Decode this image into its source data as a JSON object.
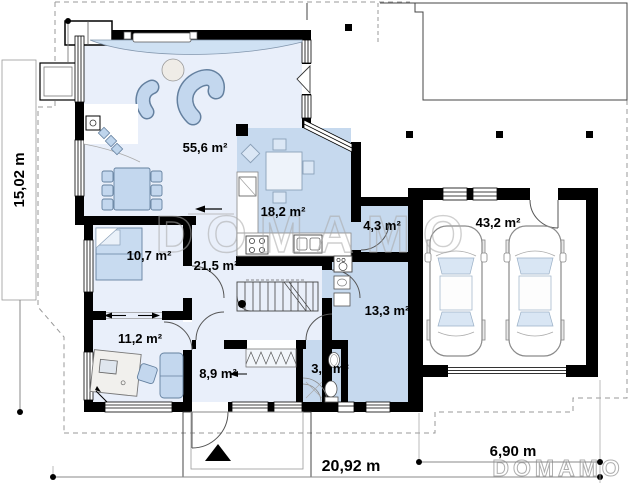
{
  "plan": {
    "watermark_center": "DOMAMO",
    "watermark_corner": "DOMAMO",
    "dimensions": {
      "height_left": "15,02 m",
      "width_bottom": "20,92 m",
      "garage_width": "6,90 m"
    },
    "rooms": [
      {
        "name": "living-room",
        "area": "55,6 m²"
      },
      {
        "name": "kitchen-dining",
        "area": "18,2 m²"
      },
      {
        "name": "pantry",
        "area": "4,3 m²"
      },
      {
        "name": "garage",
        "area": "43,2 m²"
      },
      {
        "name": "bedroom",
        "area": "10,7 m²"
      },
      {
        "name": "hall",
        "area": "21,5 m²"
      },
      {
        "name": "office",
        "area": "11,2 m²"
      },
      {
        "name": "corridor",
        "area": "8,9 m²"
      },
      {
        "name": "wc",
        "area": "3,8 m²"
      },
      {
        "name": "utility",
        "area": "13,3 m²"
      }
    ]
  },
  "colors": {
    "wall": "#000000",
    "room_light": "#e9effa",
    "room_medium": "#c6d9ee",
    "furniture": "#c3d7ee",
    "furniture_stroke": "#64809f",
    "watermark": "#a9a9a9",
    "dashed_outline": "#999999"
  }
}
